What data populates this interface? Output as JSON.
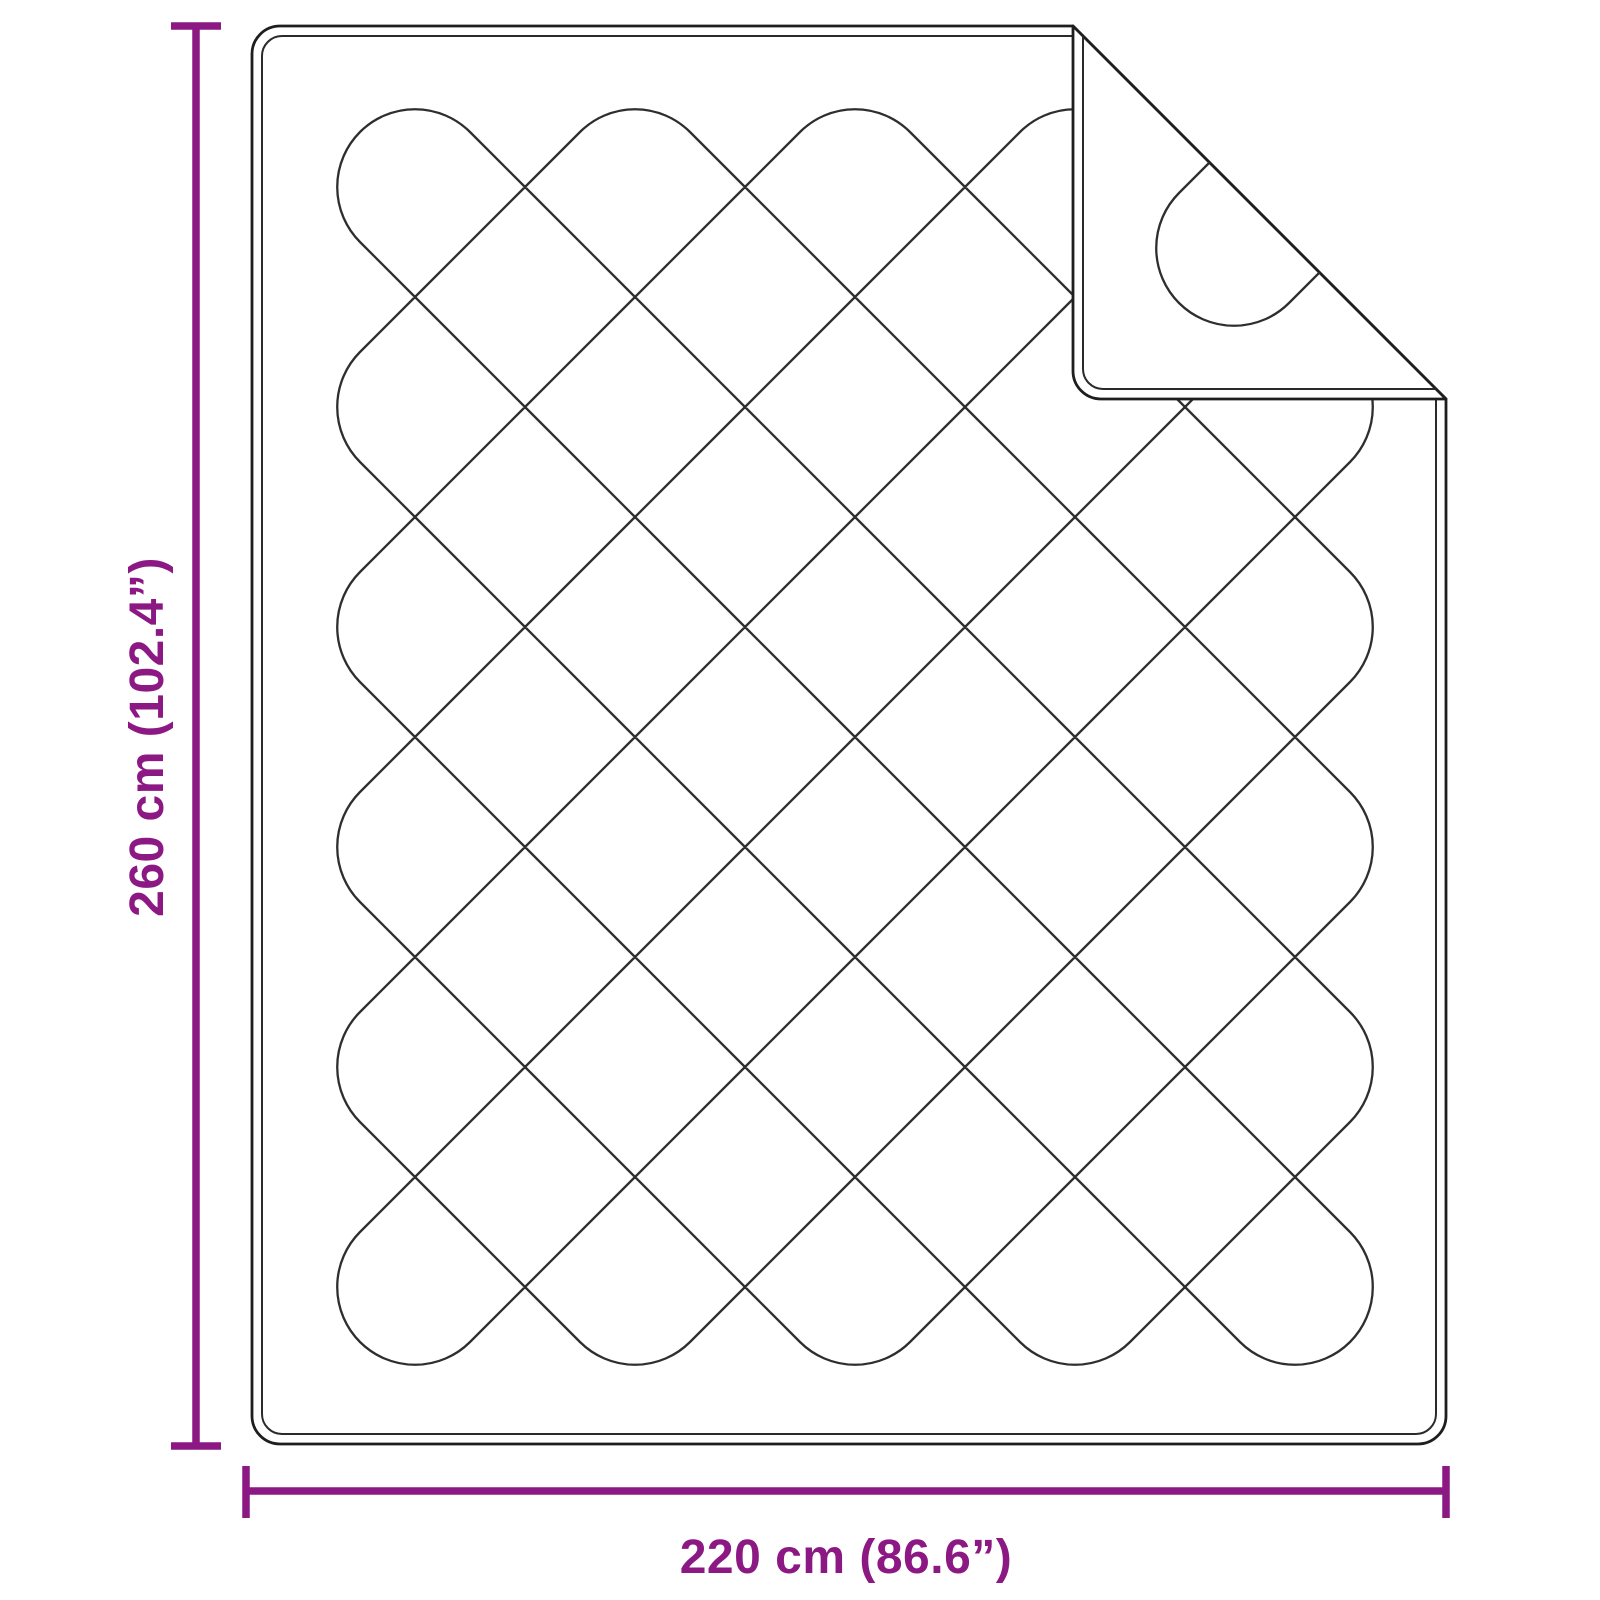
{
  "diagram": {
    "height": {
      "label": "260 cm (102.4”)",
      "cm": "260",
      "inches": "102.4"
    },
    "width": {
      "label": "220 cm (86.6”)",
      "cm": "220",
      "inches": "86.6"
    }
  },
  "colors": {
    "dimension": "#8C1983",
    "outline": "#1e1e1e",
    "stitch": "#2a2a2a",
    "pattern": "#2e2e2e",
    "background": "#ffffff"
  }
}
